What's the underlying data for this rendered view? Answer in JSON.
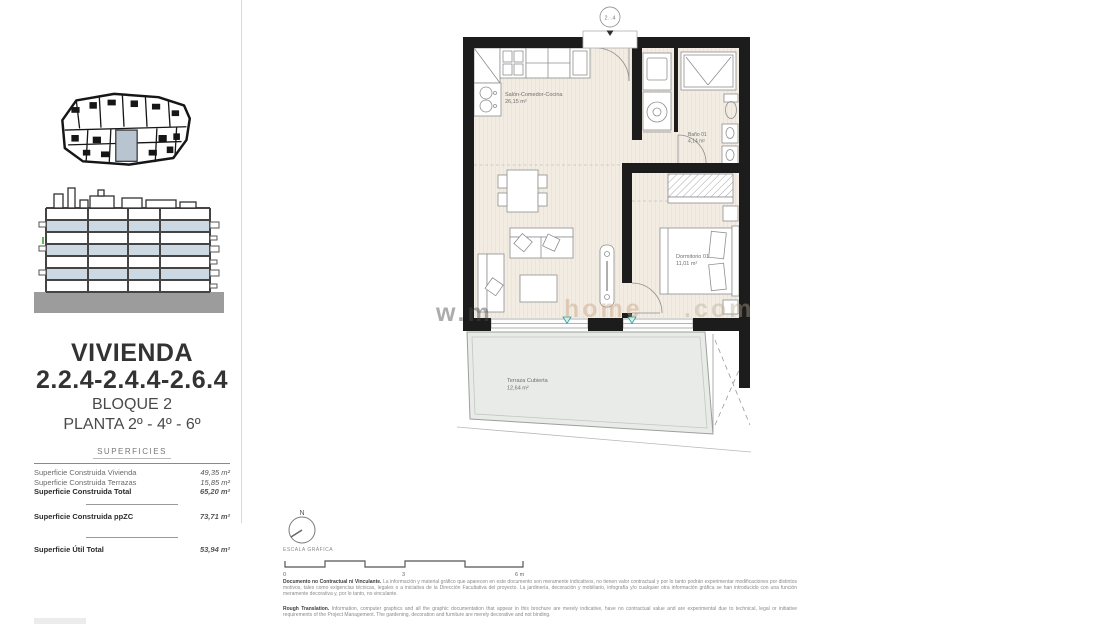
{
  "sidebar": {
    "title_line1": "VIVIENDA",
    "title_line2": "2.2.4-2.4.4-2.6.4",
    "subtitle1": "BLOQUE 2",
    "subtitle2": "PLANTA 2º - 4º - 6º",
    "table_header": "SUPERFICIES",
    "rows": [
      {
        "label": "Superficie Construida Vivienda",
        "value": "49,35 m²"
      },
      {
        "label": "Superficie Construida Terrazas",
        "value": "15,85 m²"
      },
      {
        "label": "Superficie Construida Total",
        "value": "65,20 m²"
      },
      {
        "label": "Superficie Construida ppZC",
        "value": "73,71 m²"
      },
      {
        "label": "Superficie Útil Total",
        "value": "53,94 m²"
      }
    ]
  },
  "plan": {
    "unit_badge": "2.·.4",
    "rooms": [
      {
        "name": "Salón-Comedor-Cocina",
        "area": "26,15 m²"
      },
      {
        "name": "Baño 01",
        "area": "4,14 m²"
      },
      {
        "name": "Dormitorio 01",
        "area": "11,01 m²"
      },
      {
        "name": "Terraza Cubierta",
        "area": "12,64 m²"
      }
    ],
    "colors": {
      "wall": "#1c1c1c",
      "floor": "#f2ece3",
      "terrace": "#e9ebe8",
      "accent_teal": "#2e9d9d",
      "elevation_blue": "#ccd8e2"
    }
  },
  "scale": {
    "north_label": "N",
    "caption": "ESCALA GRÁFICA",
    "tick0": "0",
    "tick1": "3",
    "tick2": "6 m"
  },
  "footer": {
    "es_lead": "Documento no Contractual ni Vinculante.",
    "es_body": " La información y material gráfico que aparecen en este documento son meramente indicativos, no tienen valor contractual y por lo tanto podrán experimentar modificaciones por distintos motivos, tales como exigencias técnicas, legales o a iniciativa de la Dirección Facultativa del proyecto. La jardinería, decoración y mobiliario, infografía y/o cualquier otra información gráfica se han introducido con una función meramente decorativa y, por lo tanto, no vinculante.",
    "en_lead": "Rough Translation.",
    "en_body": " Information, computer graphics and all the graphic documentation that appear in this brochure are merely indicative, have no contractual value and are experimental due to technical, legal or initiative requirements of the Project Management. The gardening, decoration and furniture are merely decorative and not binding."
  },
  "watermark": {
    "fragment1": "w.m",
    "fragment2": "home",
    "fragment3": ".com"
  }
}
